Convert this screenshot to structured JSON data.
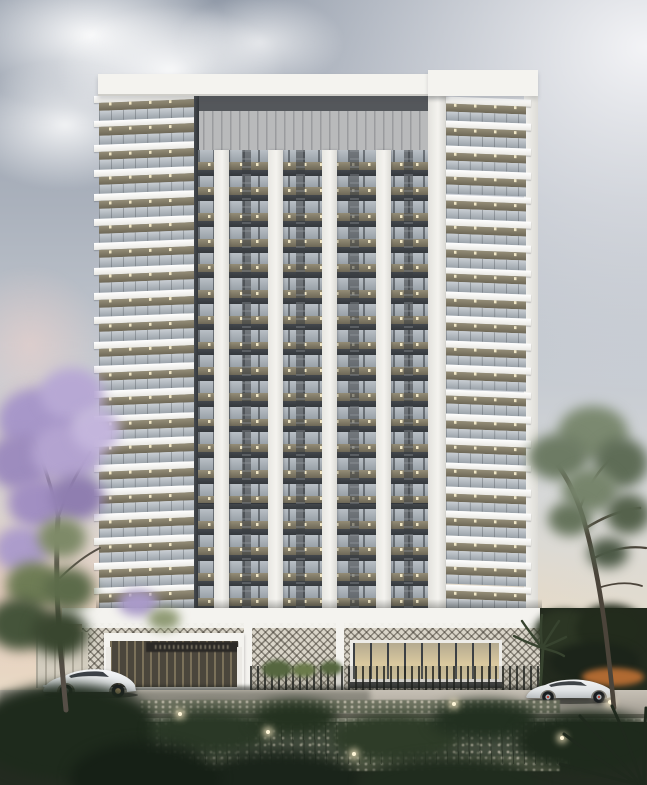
{
  "scene": {
    "title": "Architectural rendering of a white high-rise residential tower at dusk",
    "setting": "street-level view with landscaped foreground, road, and two parked white sports cars",
    "time_of_day": "dusk"
  },
  "palette": {
    "sky_top": "#929ba9",
    "horizon_warm": "#e8ddc9",
    "bldg_white": "#f4f3ef",
    "mech_gray": "#b9babb",
    "soffit": "#948d77",
    "soffit_dark": "#6e6857",
    "light_dot": "#f6ecca",
    "core_bg": "#33373c",
    "lattice_light": "#d9d4c8",
    "sign_dark": "#2b2926",
    "storefront_glow": "#d8c79e",
    "mullion": "#3c4044",
    "curb": "#716c63",
    "ground_dark": "#232b20",
    "speckle": "#cfc9b8",
    "jacaranda": "#a797c9",
    "hedge_orange": "#b06a32",
    "car_white": "#edeff0"
  },
  "tower": {
    "wing_floors": 21,
    "center_rows": 18,
    "center_piers": 5,
    "wings": [
      "left",
      "right"
    ],
    "balconies_lit": true
  },
  "podium": {
    "lattice_panels": 3,
    "entrance_sign": {
      "visible": true,
      "legible": false
    },
    "storefront_lit": true
  },
  "street": {
    "cars": [
      {
        "color": "white",
        "type": "sports-coupe",
        "position": "left",
        "facing": "left"
      },
      {
        "color": "white",
        "type": "sports-sedan",
        "position": "right",
        "facing": "left"
      }
    ]
  },
  "landscape": {
    "left_tree": "jacaranda with purple blossoms",
    "right_tree": "green canopy tree",
    "foreground": "dark shrubs, gravel planting beds, small path lights",
    "path_lights": 6
  }
}
